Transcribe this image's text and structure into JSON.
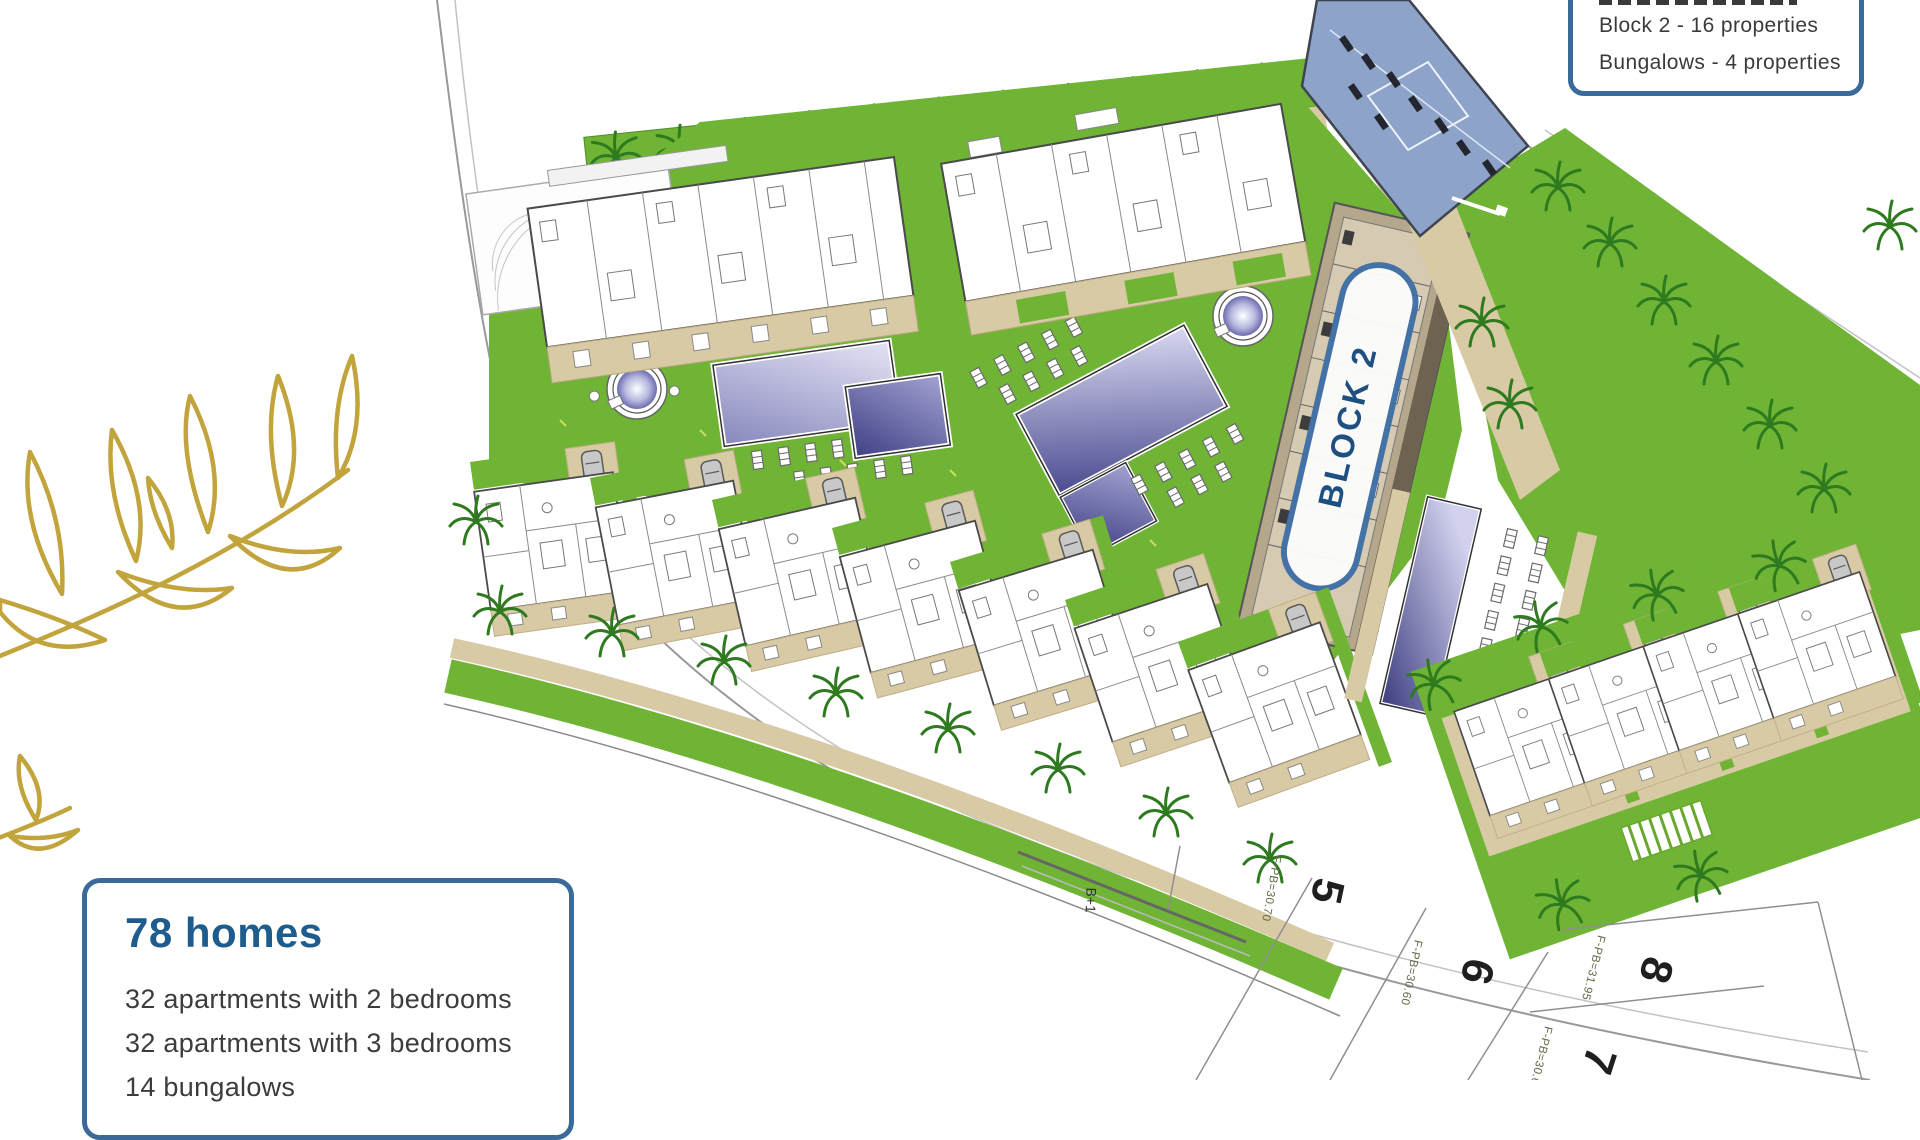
{
  "legend": {
    "lines": [
      "Block 2 - 16 properties",
      "Bungalows - 4 properties"
    ]
  },
  "summary": {
    "title": "78 homes",
    "lines": [
      "32 apartments with 2 bedrooms",
      "32 apartments with 3 bedrooms",
      "14 bungalows"
    ]
  },
  "plan": {
    "block_label": "BLOCK 2",
    "plots": [
      "5",
      "6",
      "7",
      "8"
    ],
    "levels": [
      "F-PB=30.70",
      "F-PB=30.60",
      "F-PB=30.60",
      "F-PB=31.95"
    ],
    "note": "B+1"
  },
  "colors": {
    "accent_blue": "#3a6a9a",
    "title_blue": "#1d5c8c",
    "lawn_green": "#6fb434",
    "tree_green": "#2e7a1f",
    "road_beige": "#d8caa4",
    "parking_blue": "#8da3c9",
    "pool_purple": "#4a4a90",
    "branch_gold": "#c2a43c",
    "text_gray": "#3c3c3c"
  }
}
